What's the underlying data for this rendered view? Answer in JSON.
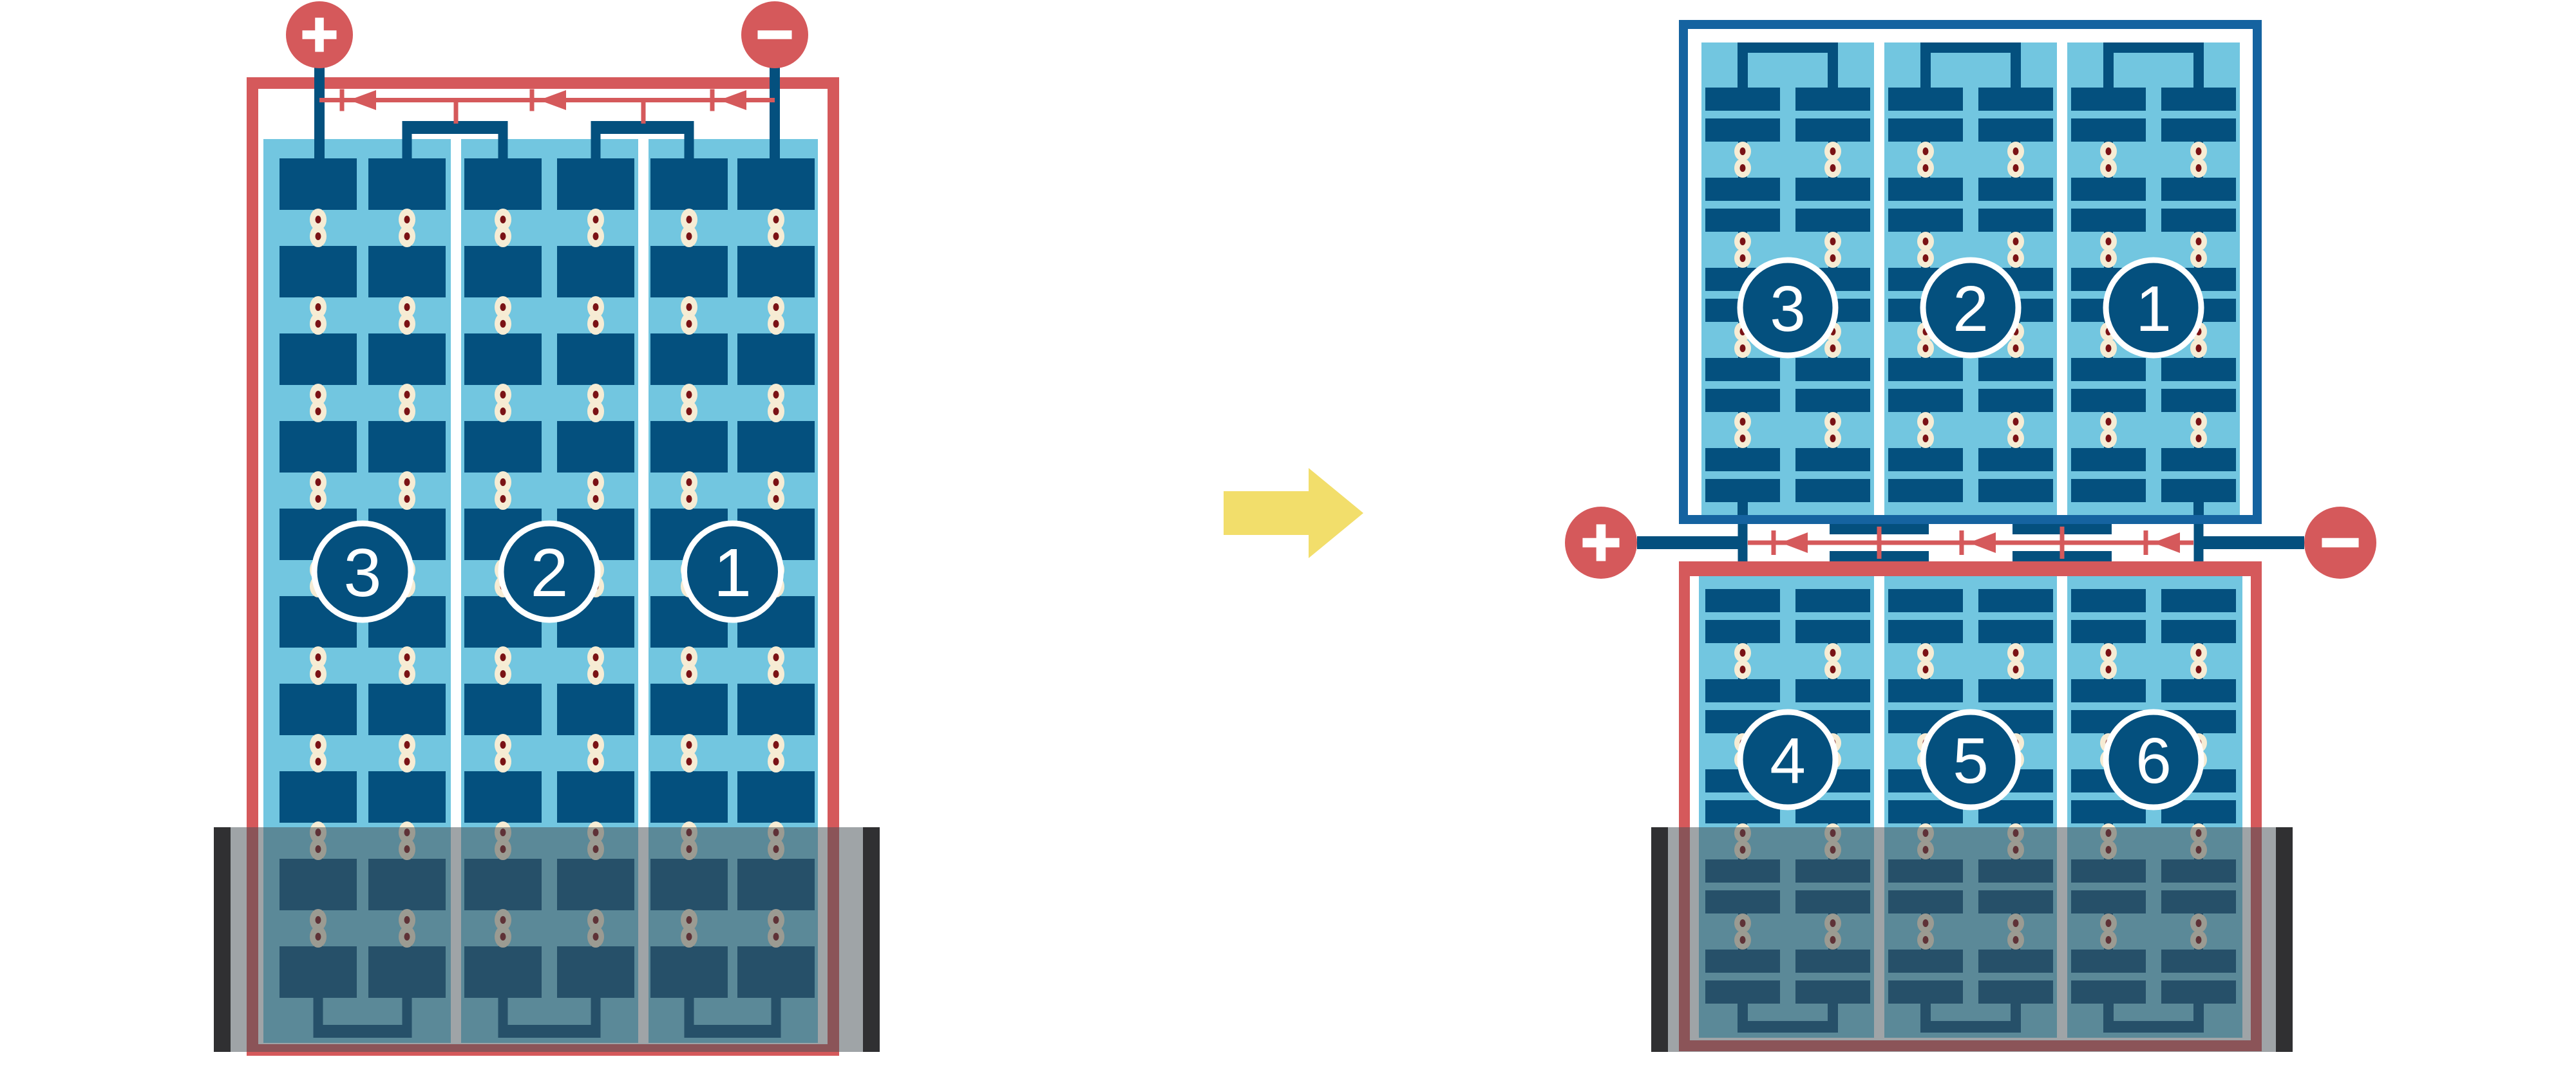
{
  "colors": {
    "red": "#D5595B",
    "navy": "#04507E",
    "frame_blue": "#1563A0",
    "light_blue": "#72C6E0",
    "cream": "#F6ECD4",
    "rivet_red": "#7A1215",
    "yellow": "#F2DE6B",
    "white": "#FFFFFF",
    "overlay_gray": "rgba(70,80,86,0.52)",
    "end_bar_gray": "rgba(35,36,38,0.9)"
  },
  "left_battery": {
    "terminals": {
      "positive": "+",
      "negative": "−"
    },
    "cells": [
      {
        "label": "3"
      },
      {
        "label": "2"
      },
      {
        "label": "1"
      }
    ],
    "plate_rows": 10,
    "plate_columns_per_cell": 2,
    "flow_arrows": 3
  },
  "transition": {
    "arrow_icon": "right-arrow"
  },
  "right_battery": {
    "top_panel": {
      "cells": [
        {
          "label": "3"
        },
        {
          "label": "2"
        },
        {
          "label": "1"
        }
      ],
      "plate_rows": 10
    },
    "bottom_panel": {
      "cells": [
        {
          "label": "4"
        },
        {
          "label": "5"
        },
        {
          "label": "6"
        }
      ],
      "plate_rows": 10
    },
    "terminals": {
      "positive": "+",
      "negative": "−"
    },
    "flow_arrows": 3
  }
}
